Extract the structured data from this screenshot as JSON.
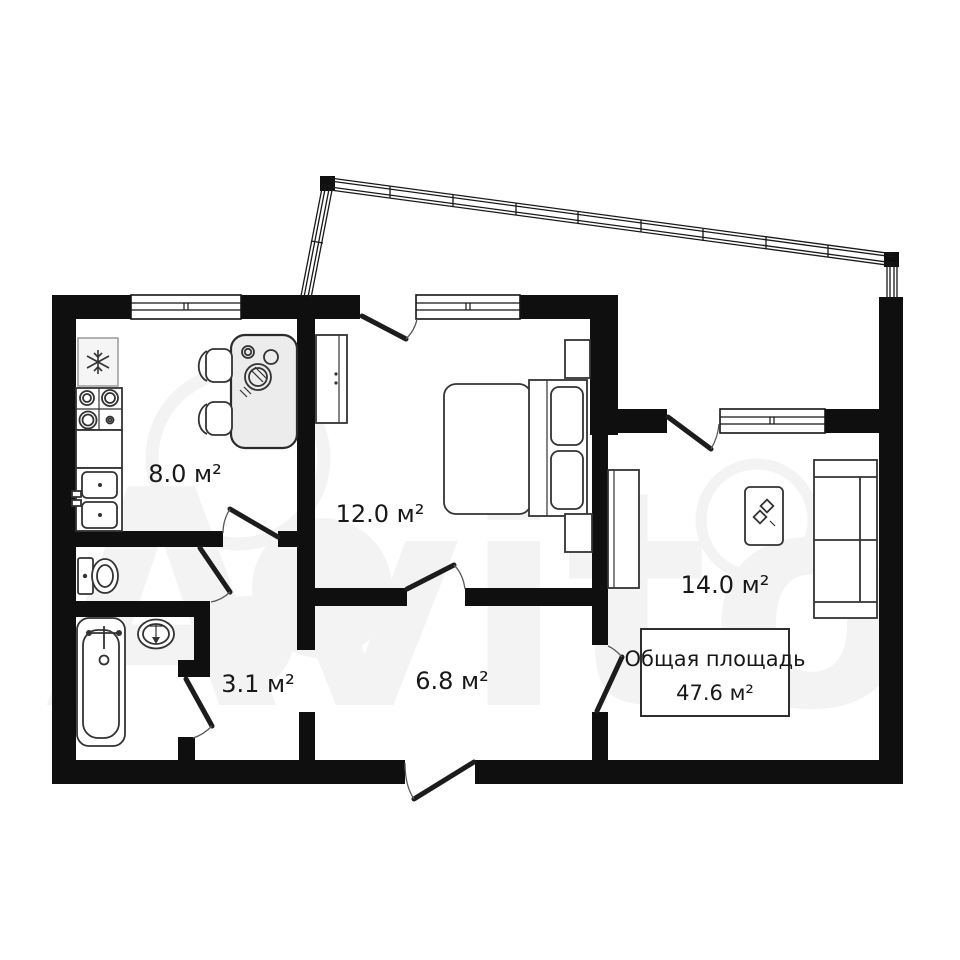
{
  "floor_plan": {
    "watermark_text": "Avito",
    "total_area_box": {
      "line1": "Общая площадь",
      "line2": "47.6 м²"
    },
    "room_labels": {
      "kitchen": "8.0 м²",
      "bedroom": "12.0 м²",
      "living_room": "14.0 м²",
      "bathroom_hall": "3.1 м²",
      "hallway": "6.8 м²"
    },
    "colors": {
      "wall": "#0f0f0f",
      "background": "#ffffff",
      "furniture_stroke": "#333333",
      "watermark": "#000000"
    }
  }
}
